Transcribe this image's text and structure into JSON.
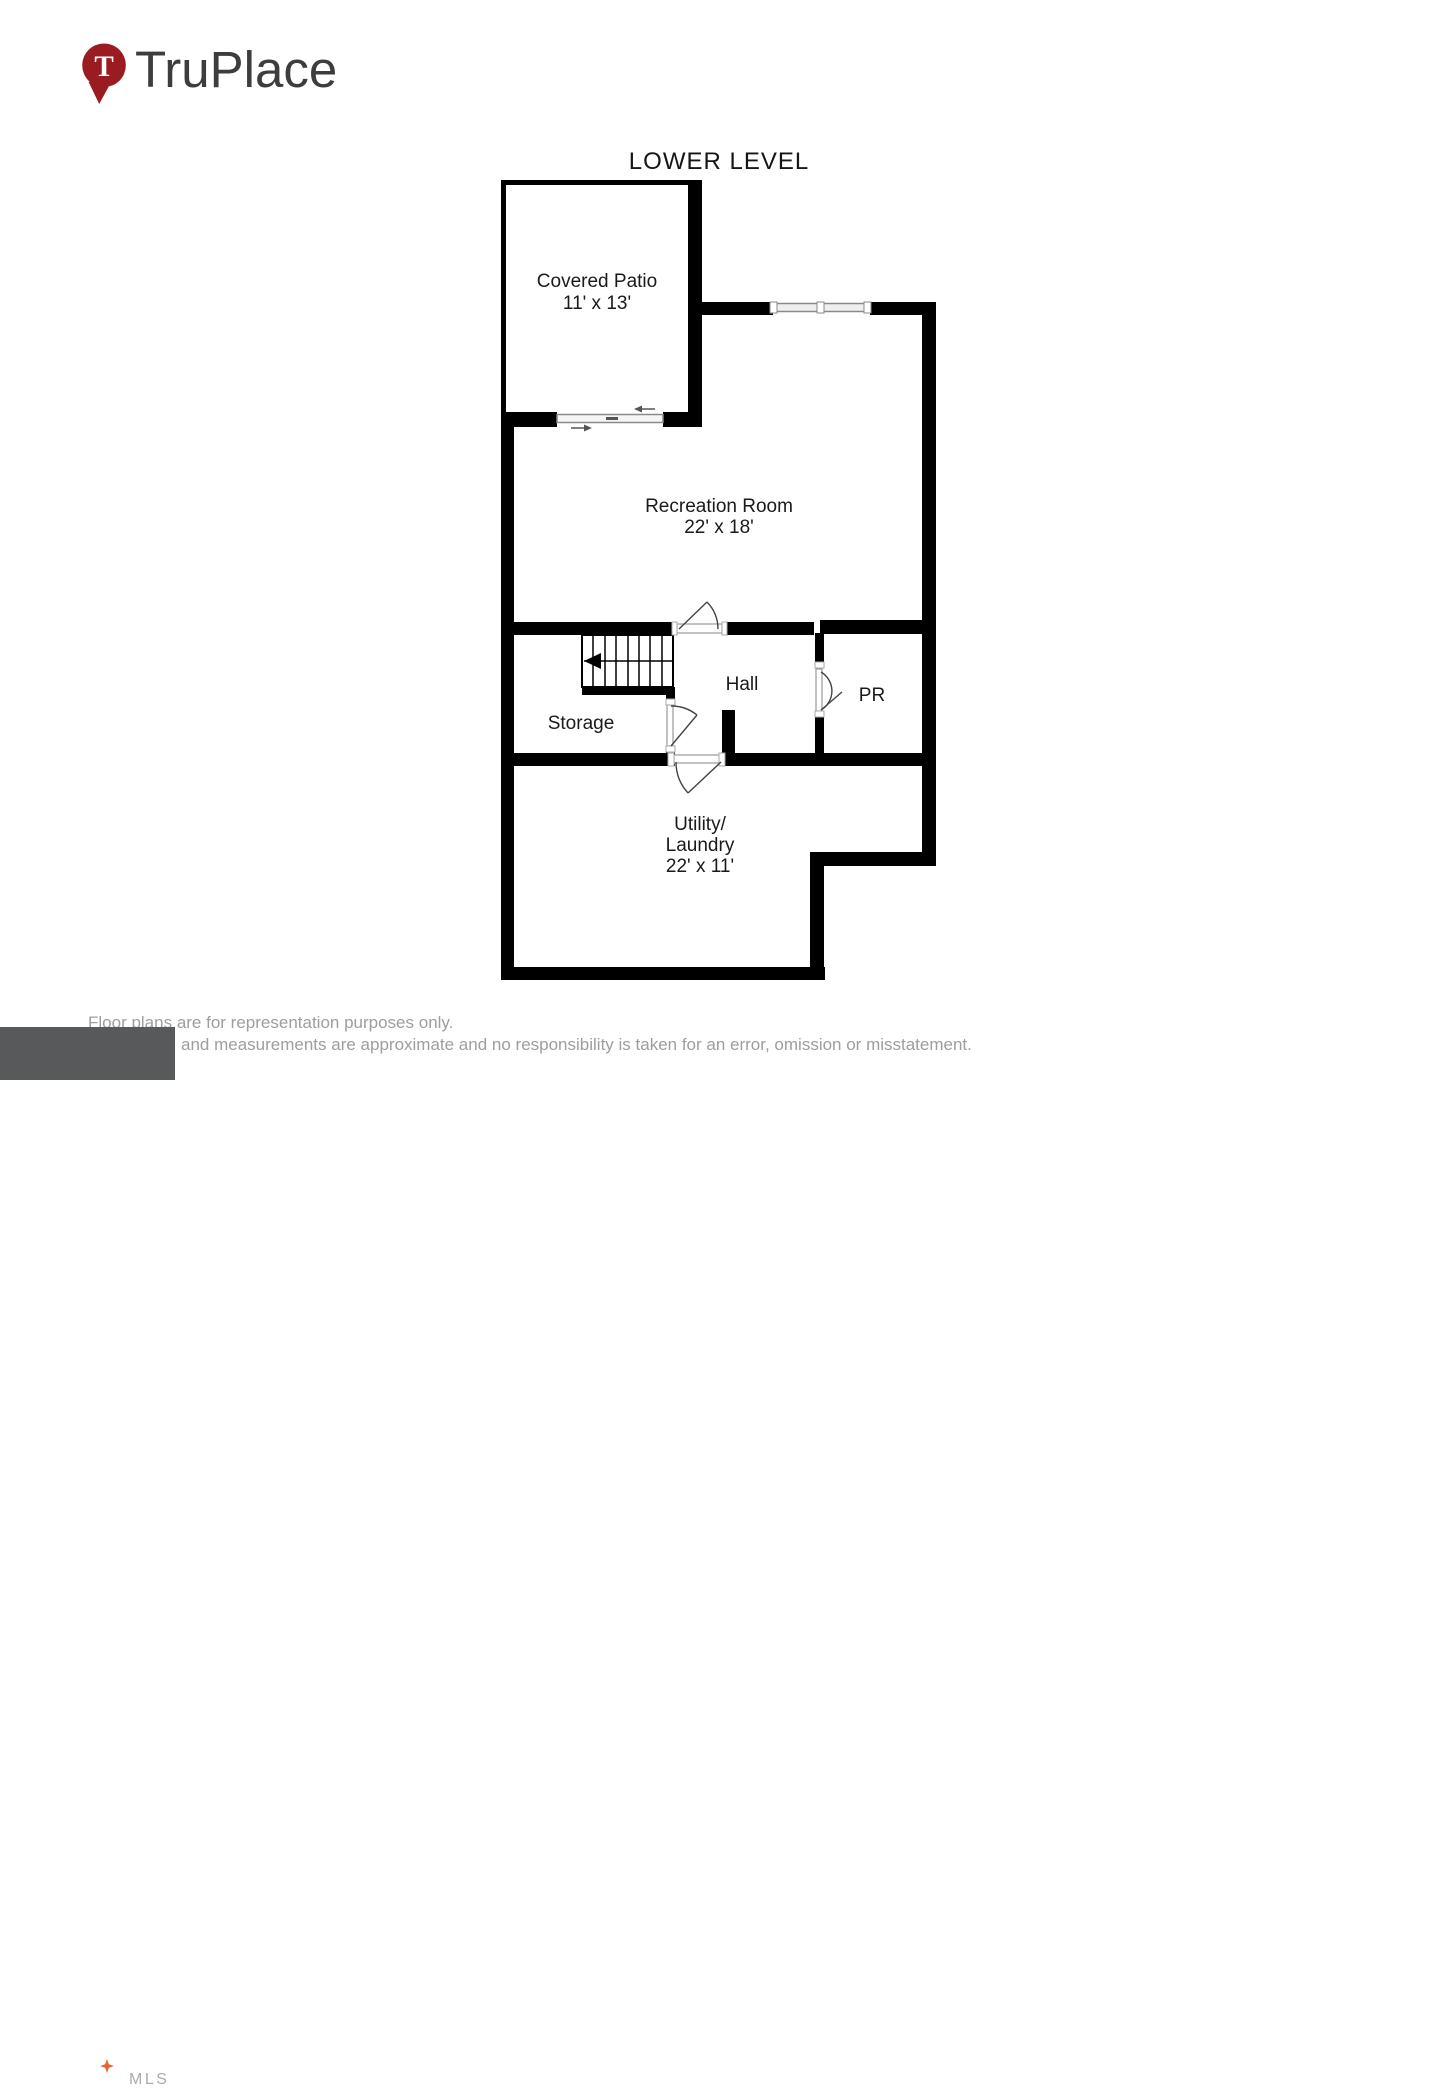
{
  "brand": {
    "name": "TruPlace",
    "pin_letter": "T",
    "pin_color": "#9a1c20"
  },
  "plan": {
    "title": "LOWER LEVEL",
    "wall_color": "#000000",
    "rooms": {
      "covered_patio": {
        "name": "Covered Patio",
        "dims": "11' x 13'"
      },
      "recreation": {
        "name": "Recreation Room",
        "dims": "22' x 18'"
      },
      "hall": {
        "name": "Hall"
      },
      "storage": {
        "name": "Storage"
      },
      "pr": {
        "name": "PR"
      },
      "utility": {
        "name_line1": "Utility/",
        "name_line2": "Laundry",
        "dims": "22' x 11'"
      }
    }
  },
  "footer": {
    "disclaimer_line1": "Floor plans are for representation purposes only.",
    "disclaimer_line2": "and measurements are approximate and no responsibility is taken for an error, omission or misstatement.",
    "text_color": "#9e9e9e",
    "mls_logo": {
      "word": "bright",
      "suffix": "MLS",
      "trademark": "™",
      "bg_color": "#58595b",
      "star_color": "#e8622d"
    }
  }
}
